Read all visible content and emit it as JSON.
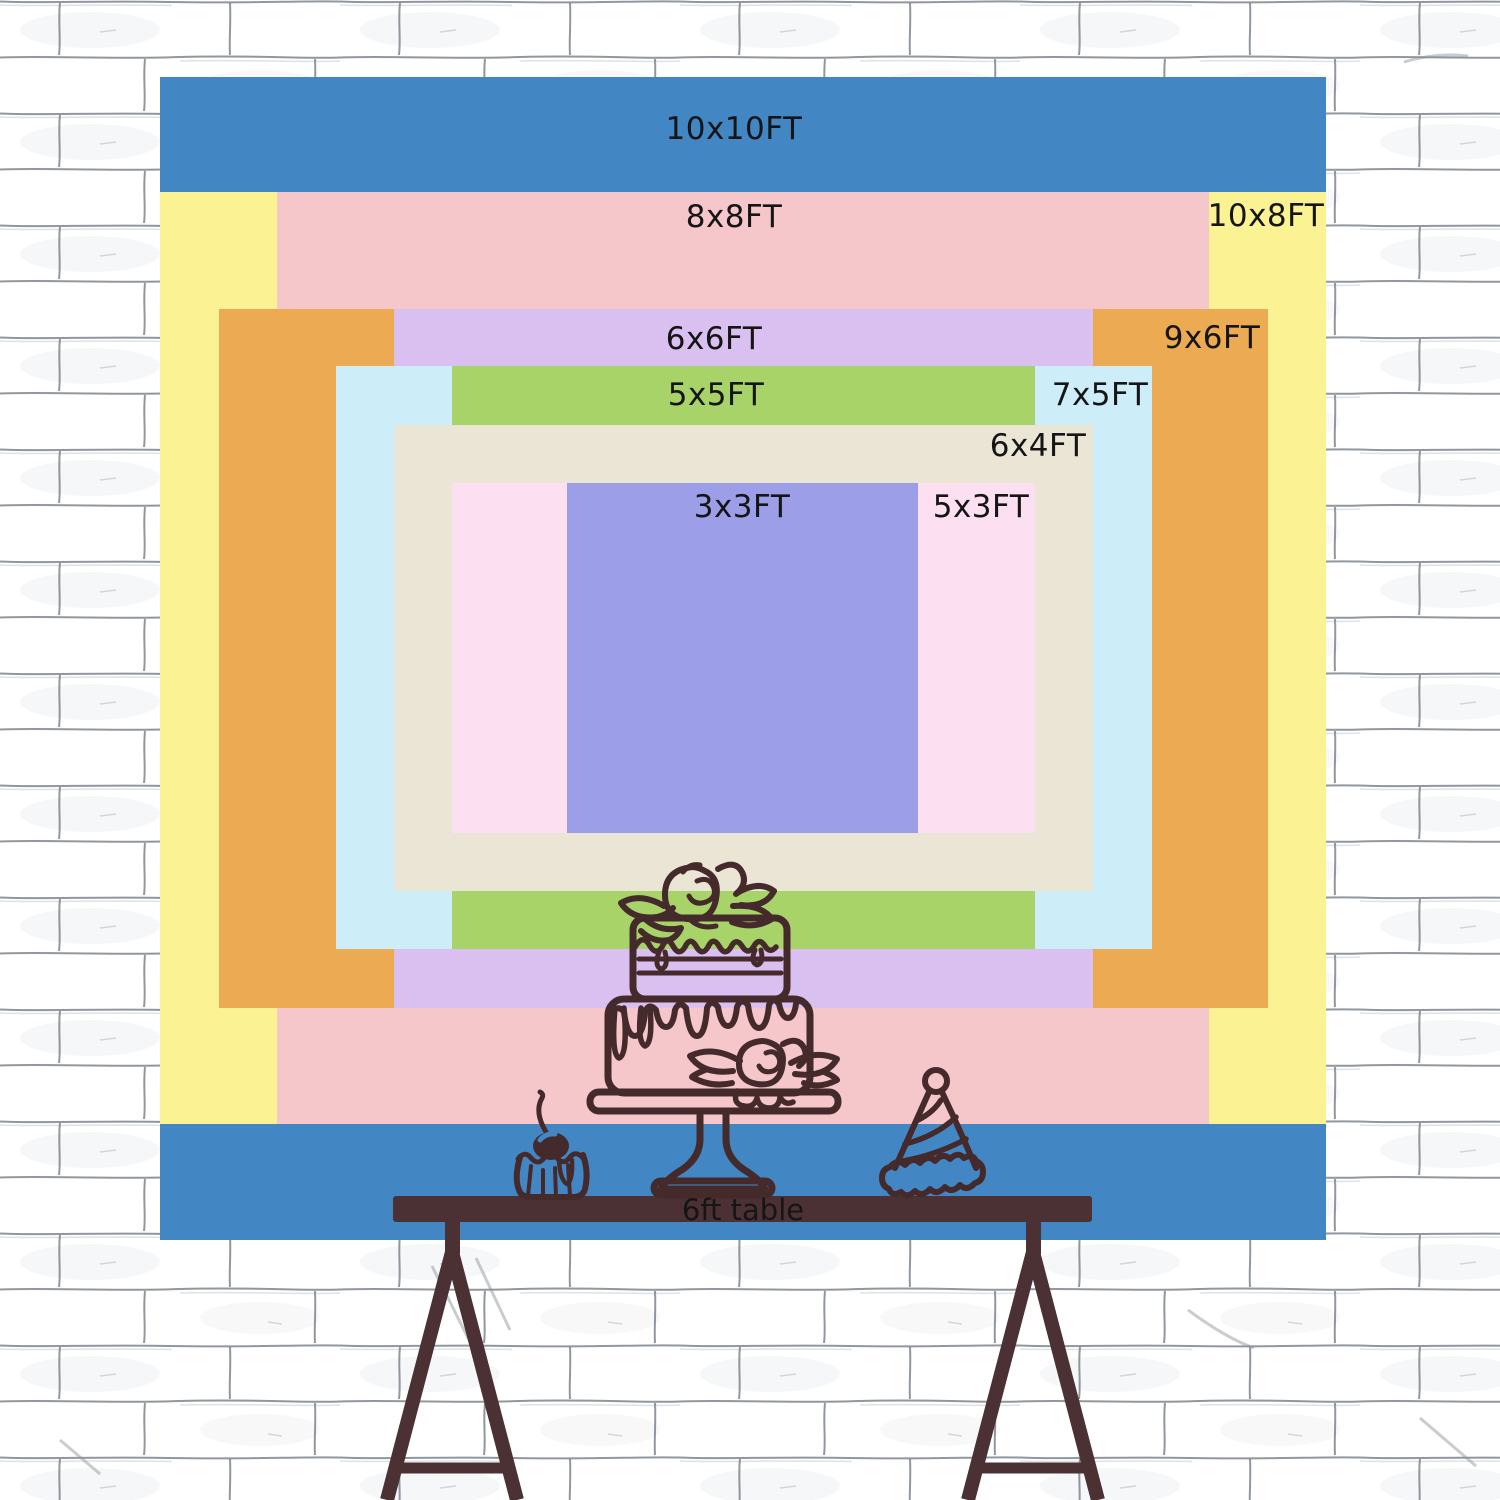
{
  "title": "Backdrop size comparison chart",
  "layers": [
    {
      "size_ft": "10x10",
      "label": "10x10FT",
      "color": "#4386c4",
      "x": 160,
      "y": 77,
      "w": 1166,
      "h": 1163,
      "lx": 734,
      "ly": 129
    },
    {
      "size_ft": "10x8",
      "label": "10x8FT",
      "color": "#fbf294",
      "x": 160,
      "y": 192,
      "w": 1166,
      "h": 932,
      "lx": 1266,
      "ly": 216
    },
    {
      "size_ft": "8x8",
      "label": "8x8FT",
      "color": "#f5c6ca",
      "x": 277,
      "y": 192,
      "w": 932,
      "h": 932,
      "lx": 734,
      "ly": 217
    },
    {
      "size_ft": "9x6",
      "label": "9x6FT",
      "color": "#ecaa52",
      "x": 219,
      "y": 309,
      "w": 1049,
      "h": 699,
      "lx": 1212,
      "ly": 338
    },
    {
      "size_ft": "6x6",
      "label": "6x6FT",
      "color": "#d9c0f0",
      "x": 394,
      "y": 309,
      "w": 699,
      "h": 699,
      "lx": 714,
      "ly": 339
    },
    {
      "size_ft": "7x5",
      "label": "7x5FT",
      "color": "#cdeef8",
      "x": 336,
      "y": 366,
      "w": 816,
      "h": 583,
      "lx": 1100,
      "ly": 395
    },
    {
      "size_ft": "5x5",
      "label": "5x5FT",
      "color": "#a8d368",
      "x": 452,
      "y": 366,
      "w": 583,
      "h": 583,
      "lx": 716,
      "ly": 395
    },
    {
      "size_ft": "6x4",
      "label": "6x4FT",
      "color": "#eae5d4",
      "x": 394,
      "y": 425,
      "w": 699,
      "h": 466,
      "lx": 1038,
      "ly": 446
    },
    {
      "size_ft": "5x3",
      "label": "5x3FT",
      "color": "#fcdff0",
      "x": 452,
      "y": 483,
      "w": 583,
      "h": 350,
      "lx": 981,
      "ly": 507
    },
    {
      "size_ft": "3x3",
      "label": "3x3FT",
      "color": "#9c9ee8",
      "x": 567,
      "y": 483,
      "w": 351,
      "h": 350,
      "lx": 742,
      "ly": 507
    }
  ],
  "table": {
    "label": "6ft table"
  },
  "colors": {
    "line": "#452a2c",
    "table": "#4b3134",
    "label_text": "#151515",
    "wall_line": "#7e848c",
    "wall_bg": "#ffffff",
    "blue": "#4386c4"
  }
}
